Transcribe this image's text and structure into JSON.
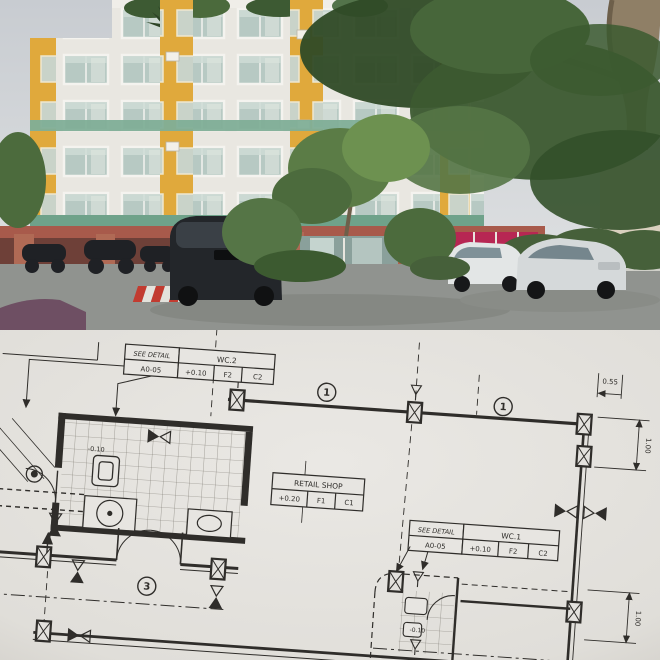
{
  "photo": {
    "alt": "Mid-rise condominium with yellow-and-white facade, terracotta carport base, large trees and parked cars",
    "colors": {
      "sky": "#cdd0d4",
      "facade_white": "#e9e7e1",
      "facade_yellow": "#e0a93c",
      "band_teal": "#7fae97",
      "base_terracotta": "#a85a4b",
      "carport_shadow": "#6e4038",
      "door_pink": "#b72753",
      "foliage_dark": "#2f4a26",
      "foliage_mid": "#47663a",
      "foliage_light": "#6d9150",
      "trunk": "#8f7f66",
      "asphalt": "#90938f",
      "glass": "#b7c9c3"
    }
  },
  "plan": {
    "colors": {
      "paper": "#e3e1dd",
      "ink": "#2f2d2a"
    },
    "callouts": {
      "wc2": {
        "note1": "SEE DETAIL",
        "note2": "A0-05",
        "title": "WC.2",
        "cells": [
          "+0.10",
          "F2",
          "C2"
        ]
      },
      "retail": {
        "title": "RETAIL SHOP",
        "cells": [
          "+0.20",
          "F1",
          "C1"
        ]
      },
      "wc1": {
        "note1": "SEE DETAIL",
        "note2": "A0-05",
        "title": "WC.1",
        "cells": [
          "+0.10",
          "F2",
          "C2"
        ]
      }
    },
    "grid_bubbles": {
      "b1": "1",
      "b2": "1",
      "door": "3"
    },
    "dimensions": {
      "d1": "0.55",
      "d2": "1.00",
      "d3": "1.00"
    },
    "levels": {
      "wc_left": "-0.10",
      "wc_right": "-0.10"
    }
  }
}
